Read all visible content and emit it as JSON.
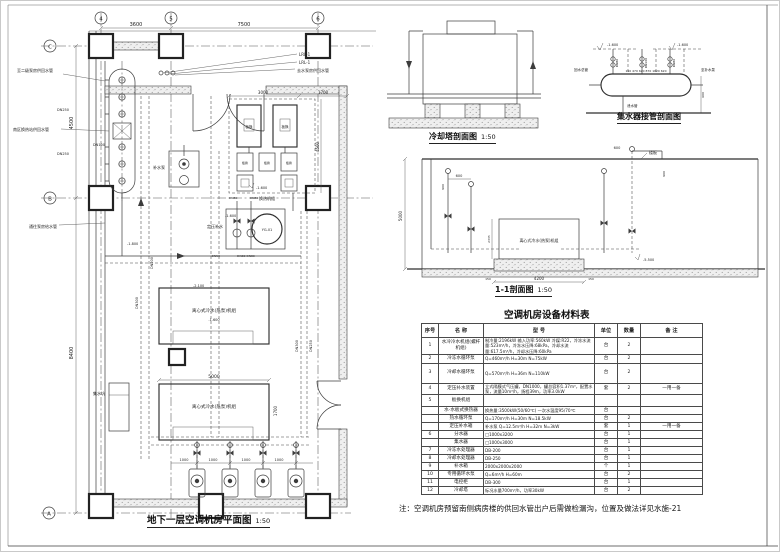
{
  "plan": {
    "title": "地下一层空调机房平面图",
    "scale": "1:50",
    "axes_top": [
      "4",
      "5",
      "6"
    ],
    "axes_left": [
      "C",
      "B",
      "A"
    ],
    "dims": {
      "d3600": "3600",
      "d7500": "7500",
      "d4500": "4500",
      "d8400": "8400",
      "d3000": "3000",
      "d1700t": "1700",
      "d4500b": "4500",
      "d5000": "5000",
      "d1700r": "1700",
      "d1000": "1000"
    },
    "labels": {
      "lrl1": "LRL-1",
      "lrl2": "LRL-1",
      "leader_top_l": "至二级泵房供回水管",
      "leader_top_r": "去水泵房供回水管",
      "leader_left1": "南区换热站供回水管",
      "leader_left2": "通往泵房给水管",
      "dn250a": "DN250",
      "dn250b": "DN250",
      "dn100": "DN100",
      "dn200": "DN200",
      "dn300a": "DN300",
      "dn300b": "DN300",
      "dn250c": "DN250",
      "dn80a": "DN80",
      "dn80b": "DN80",
      "dn80c": "DN80 DN80",
      "dn50": "DN50",
      "hx1": "板换",
      "hx2": "板换",
      "hx3": "板换",
      "hx4": "板换",
      "hx5": "板换",
      "hx_unit": "换热机组",
      "elev_plat": "-1.600",
      "elev_a": "-1.600",
      "elev_c": "-1.800",
      "elev_d": "-2.100",
      "elev_ch": "-1.600",
      "pump_station": "补水泵",
      "ptank": "YG-01",
      "ptank_label": "定压补水",
      "chiller1": "离心式冷水(热泵)机组",
      "chiller2": "离心式冷水(热泵)机组",
      "sump": "集水坑"
    }
  },
  "cooling_tower": {
    "title": "冷却塔剖面图",
    "scale": "1:50"
  },
  "collector": {
    "title": "集水器接管剖面图",
    "elev_l": "-1.600",
    "elev_r": "-1.600",
    "label_left": "回水总管",
    "label_right": "至补水泵",
    "label_drain": "泄水管",
    "dims": "150 470 620 870 1620 620",
    "dim600": "600",
    "dn1": "DN80",
    "dn2": "DN100",
    "dn3": "DN80"
  },
  "section11": {
    "title": "1-1剖面图",
    "scale": "1:50",
    "slab": "楼板",
    "machine": "离心式冷水(热泵)机组",
    "elev": "-5.500",
    "dim_w": "4200",
    "dim150": "150",
    "dim_h": "5000",
    "dim600": "600",
    "dim600b": "600",
    "dim900": "900",
    "dim2335": "2335"
  },
  "table": {
    "title": "空调机房设备材料表",
    "headers": [
      "序号",
      "名 称",
      "型 号",
      "单位",
      "数量",
      "备 注"
    ],
    "rows": [
      [
        "1",
        "水冷冷水机组(螺杆机组)",
        "制冷量:2196kW 输入功率:560kW 冷媒:R22，冷冻水流量:523m³/h，冷冻水压降:68kPa，冷却水流量:617.5m³/h，冷却水压降:60kPa",
        "台",
        "2",
        ""
      ],
      [
        "2",
        "冷冻水循环泵",
        "Q=460m³/h  H=30m  N=75kW",
        "台",
        "2",
        ""
      ],
      [
        "3",
        "冷却水循环泵",
        "Q=570m³/h  H=36m  N=110kW",
        "台",
        "2",
        ""
      ],
      [
        "4",
        "定压补水装置",
        "立式隔膜式气压罐，DN1000，罐总容积1.37m³，配置水泵，流量10m³/h，扬程39m，功率3.0kW",
        "套",
        "2",
        "一用一备"
      ],
      [
        "5",
        "板换机组",
        "",
        "",
        "",
        ""
      ],
      [
        "",
        "水-水板式换热器",
        "换热量:3500kW(50/60℃)  一次水温度95/70℃",
        "台",
        "",
        ""
      ],
      [
        "",
        "热水循环泵",
        "Q=170m³/h  H=30m  N=18.5kW",
        "台",
        "2",
        ""
      ],
      [
        "",
        "定压补水箱",
        "补水泵 Q=12.5m³/h  H=32m  N=3kW",
        "套",
        "1",
        "一用一备"
      ],
      [
        "6",
        "分水器",
        "□1000x3200",
        "台",
        "1",
        ""
      ],
      [
        "",
        "集水器",
        "□1000x3000",
        "台",
        "1",
        ""
      ],
      [
        "7",
        "冷冻水处理器",
        "DB-200",
        "台",
        "1",
        ""
      ],
      [
        "8",
        "冷却水处理器",
        "DB-250",
        "台",
        "1",
        ""
      ],
      [
        "9",
        "补水箱",
        "2000x2000x2000",
        "个",
        "1",
        ""
      ],
      [
        "10",
        "专用循环水泵",
        "Q=6m³/h  H=60m",
        "台",
        "2",
        ""
      ],
      [
        "11",
        "电控柜",
        "DB-300",
        "台",
        "1",
        ""
      ],
      [
        "12",
        "冷却塔",
        "标况水量700m³/h，功率30kW",
        "台",
        "2",
        ""
      ]
    ]
  },
  "note": "注：空调机房预留南侧病房楼的供回水管出户后需做检漏沟，位置及做法详见水施-21"
}
